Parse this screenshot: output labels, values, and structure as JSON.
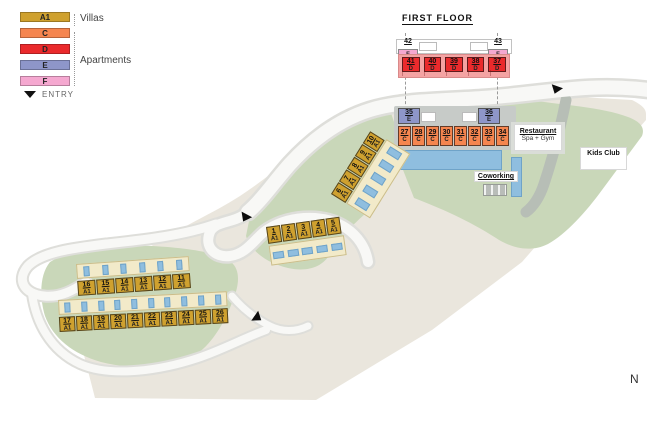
{
  "legend": {
    "items": [
      {
        "code": "A1"
      },
      {
        "code": "C"
      },
      {
        "code": "D"
      },
      {
        "code": "E"
      },
      {
        "code": "F"
      }
    ],
    "villas_label": "Villas",
    "apartments_label": "Apartments",
    "entry_label": "ENTRY"
  },
  "first_floor": {
    "title": "FIRST FLOOR",
    "f_units": [
      {
        "num": "42",
        "type": "F"
      },
      {
        "num": "43",
        "type": "F"
      }
    ],
    "d_units": [
      {
        "num": "41",
        "type": "D"
      },
      {
        "num": "40",
        "type": "D"
      },
      {
        "num": "39",
        "type": "D"
      },
      {
        "num": "38",
        "type": "D"
      },
      {
        "num": "37",
        "type": "D"
      }
    ]
  },
  "ground_floor": {
    "e_units": [
      {
        "num": "35",
        "type": "E"
      },
      {
        "num": "36",
        "type": "E"
      }
    ],
    "c_units": [
      {
        "num": "27",
        "type": "C"
      },
      {
        "num": "28",
        "type": "C"
      },
      {
        "num": "29",
        "type": "C"
      },
      {
        "num": "30",
        "type": "C"
      },
      {
        "num": "31",
        "type": "C"
      },
      {
        "num": "32",
        "type": "C"
      },
      {
        "num": "33",
        "type": "C"
      },
      {
        "num": "34",
        "type": "C"
      }
    ]
  },
  "villas": {
    "diagonal_row": [
      {
        "num": "6",
        "type": "A1"
      },
      {
        "num": "7",
        "type": "A1"
      },
      {
        "num": "8",
        "type": "A1"
      },
      {
        "num": "9",
        "type": "A1"
      },
      {
        "num": "10",
        "type": "A1"
      }
    ],
    "front_row": [
      {
        "num": "1",
        "type": "A1"
      },
      {
        "num": "2",
        "type": "A1"
      },
      {
        "num": "3",
        "type": "A1"
      },
      {
        "num": "4",
        "type": "A1"
      },
      {
        "num": "5",
        "type": "A1"
      }
    ],
    "west_top_row": [
      {
        "num": "16",
        "type": "A1"
      },
      {
        "num": "15",
        "type": "A1"
      },
      {
        "num": "14",
        "type": "A1"
      },
      {
        "num": "13",
        "type": "A1"
      },
      {
        "num": "12",
        "type": "A1"
      },
      {
        "num": "11",
        "type": "A1"
      }
    ],
    "west_bottom_row": [
      {
        "num": "17",
        "type": "A1"
      },
      {
        "num": "18",
        "type": "A1"
      },
      {
        "num": "19",
        "type": "A1"
      },
      {
        "num": "20",
        "type": "A1"
      },
      {
        "num": "21",
        "type": "A1"
      },
      {
        "num": "22",
        "type": "A1"
      },
      {
        "num": "23",
        "type": "A1"
      },
      {
        "num": "24",
        "type": "A1"
      },
      {
        "num": "25",
        "type": "A1"
      },
      {
        "num": "26",
        "type": "A1"
      }
    ]
  },
  "amenities": {
    "restaurant_title": "Restaurant",
    "restaurant_subtitle": "Spa + Gym",
    "kids_club": "Kids Club",
    "coworking": "Coworking"
  },
  "compass_label": "N",
  "colors": {
    "villa_a1": "#CFA12F",
    "apartment_c": "#F5854F",
    "apartment_d": "#EA2A2C",
    "apartment_e": "#8E96C9",
    "apartment_f": "#F5A8D0",
    "pool": "#8FBEDF",
    "green": "#C9D7B9",
    "land": "#EAE6DD"
  }
}
